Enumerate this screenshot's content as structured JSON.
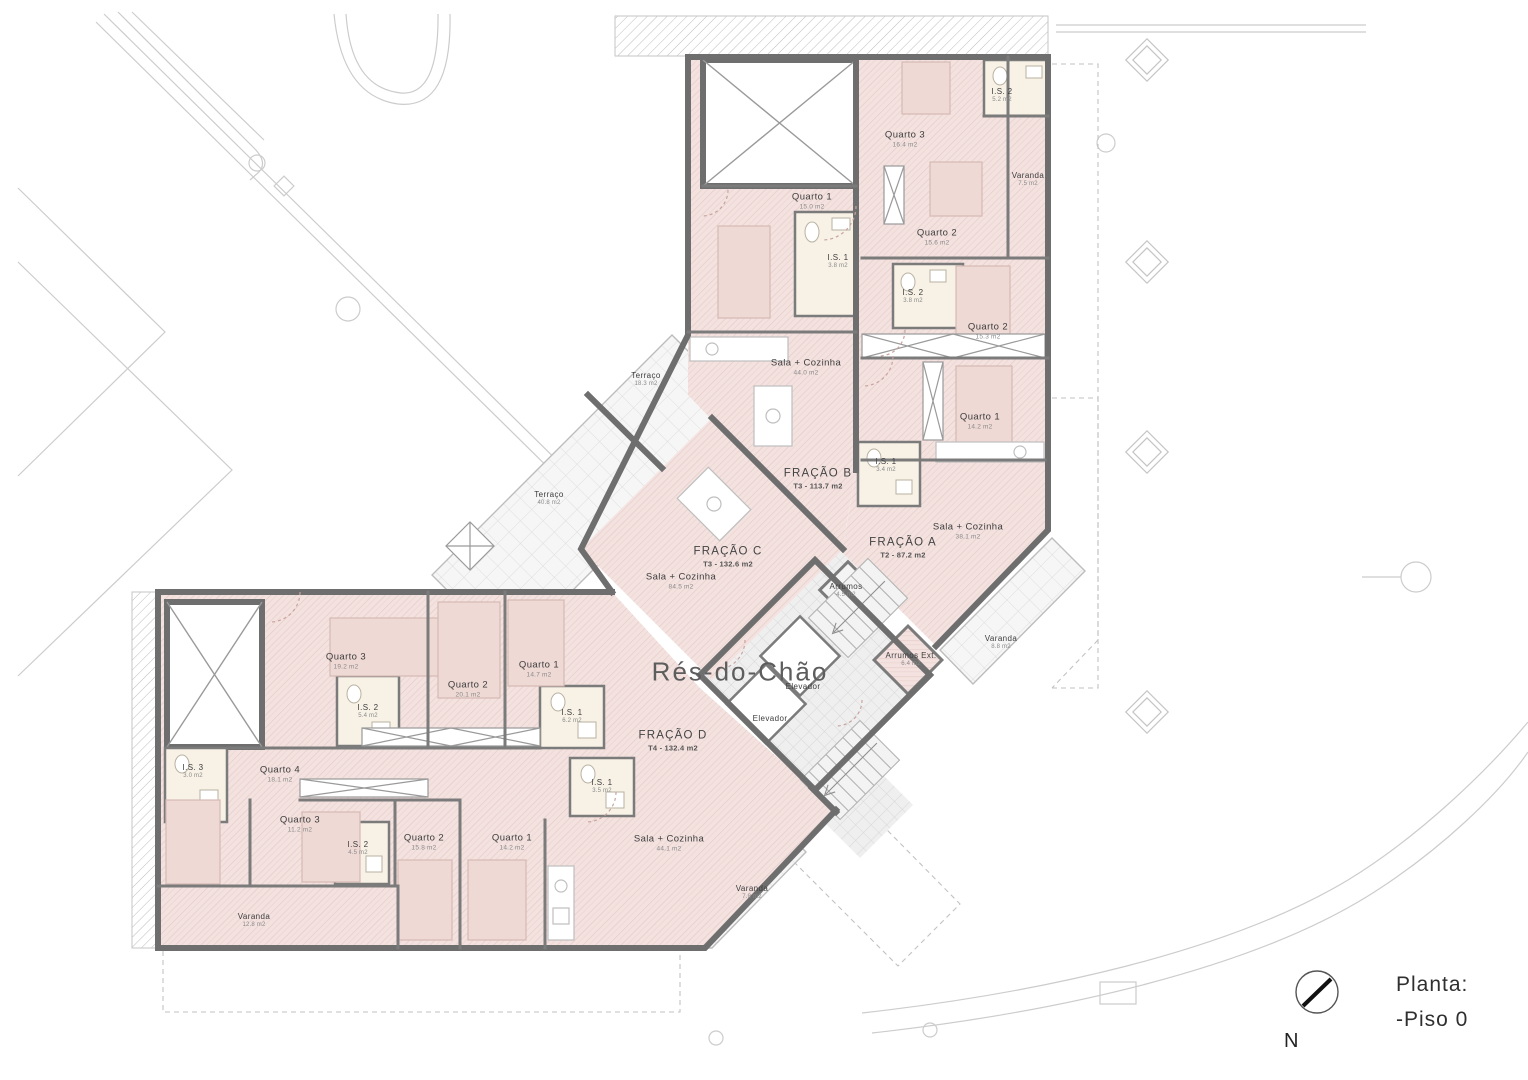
{
  "plan": {
    "floor_name": "Rés-do-Chão"
  },
  "title_block": {
    "label": "Planta:",
    "floor": "-Piso 0"
  },
  "compass": {
    "north": "N"
  },
  "palette": {
    "apartment_fill": "#f3e2df",
    "apartment_hatch": "#e4cac6",
    "terrace_fill": "#f6f6f6",
    "terrace_line": "#dddddd",
    "wall": "#6e6e6e",
    "bathroom_fill": "#f7f1e6",
    "site_line": "#cccccc",
    "text": "#3d3d3d"
  },
  "fractions_summary": [
    {
      "name": "FRAÇÃO A",
      "type_area": "T2 - 87.2 m2"
    },
    {
      "name": "FRAÇÃO B",
      "type_area": "T3 - 113.7 m2"
    },
    {
      "name": "FRAÇÃO C",
      "type_area": "T3 - 132.6 m2"
    },
    {
      "name": "FRAÇÃO D",
      "type_area": "T4 - 132.4 m2"
    }
  ],
  "rooms": [
    {
      "name": "Quarto 3",
      "area": "16.4 m2",
      "x": 905,
      "y": 140
    },
    {
      "name": "I.S. 2",
      "area": "5.2 m2",
      "x": 1002,
      "y": 96,
      "kind": "small"
    },
    {
      "name": "Varanda",
      "area": "7.5 m2",
      "x": 1028,
      "y": 180,
      "kind": "small"
    },
    {
      "name": "Quarto 2",
      "area": "15.6 m2",
      "x": 937,
      "y": 238
    },
    {
      "name": "Quarto 1",
      "area": "15.0 m2",
      "x": 812,
      "y": 202
    },
    {
      "name": "I.S. 1",
      "area": "3.8 m2",
      "x": 838,
      "y": 262,
      "kind": "small"
    },
    {
      "name": "Sala + Cozinha",
      "area": "44.0 m2",
      "x": 806,
      "y": 368
    },
    {
      "name": "I.S. 2",
      "area": "3.8 m2",
      "x": 913,
      "y": 297,
      "kind": "small"
    },
    {
      "name": "Quarto 2",
      "area": "15.3 m2",
      "x": 988,
      "y": 332
    },
    {
      "name": "Quarto 1",
      "area": "14.2 m2",
      "x": 980,
      "y": 422
    },
    {
      "name": "I.S. 1",
      "area": "3.4 m2",
      "x": 886,
      "y": 466,
      "kind": "small"
    },
    {
      "name": "Sala + Cozinha",
      "area": "38.1 m2",
      "x": 968,
      "y": 532
    },
    {
      "name": "FRAÇÃO A",
      "area": "T2 - 87.2 m2",
      "x": 903,
      "y": 548,
      "kind": "fraction"
    },
    {
      "name": "FRAÇÃO B",
      "area": "T3 - 113.7 m2",
      "x": 818,
      "y": 479,
      "kind": "fraction"
    },
    {
      "name": "Terraço",
      "area": "18.3 m2",
      "x": 646,
      "y": 380,
      "kind": "small"
    },
    {
      "name": "Terraço",
      "area": "40.8 m2",
      "x": 549,
      "y": 499,
      "kind": "small"
    },
    {
      "name": "FRAÇÃO C",
      "area": "T3 - 132.6 m2",
      "x": 728,
      "y": 557,
      "kind": "fraction"
    },
    {
      "name": "Sala + Cozinha",
      "area": "84.5 m2",
      "x": 681,
      "y": 582
    },
    {
      "name": "Elevador",
      "area": "",
      "x": 803,
      "y": 687,
      "kind": "small"
    },
    {
      "name": "Elevador",
      "area": "",
      "x": 770,
      "y": 719,
      "kind": "small"
    },
    {
      "name": "Arrumos",
      "area": "4.5 m2",
      "x": 846,
      "y": 591,
      "kind": "small"
    },
    {
      "name": "Arrumos Ext.",
      "area": "6.4 m2",
      "x": 911,
      "y": 660,
      "kind": "small"
    },
    {
      "name": "Varanda",
      "area": "8.8 m2",
      "x": 1001,
      "y": 643,
      "kind": "small"
    },
    {
      "name": "Quarto 3",
      "area": "19.2 m2",
      "x": 346,
      "y": 662
    },
    {
      "name": "I.S. 2",
      "area": "5.4 m2",
      "x": 368,
      "y": 712,
      "kind": "small"
    },
    {
      "name": "Quarto 2",
      "area": "20.1 m2",
      "x": 468,
      "y": 690
    },
    {
      "name": "Quarto 1",
      "area": "14.7 m2",
      "x": 539,
      "y": 670
    },
    {
      "name": "I.S. 1",
      "area": "6.2 m2",
      "x": 572,
      "y": 717,
      "kind": "small"
    },
    {
      "name": "FRAÇÃO D",
      "area": "T4 - 132.4 m2",
      "x": 673,
      "y": 741,
      "kind": "fraction"
    },
    {
      "name": "I.S. 1",
      "area": "3.5 m2",
      "x": 602,
      "y": 787,
      "kind": "small"
    },
    {
      "name": "I.S. 3",
      "area": "3.0 m2",
      "x": 193,
      "y": 772,
      "kind": "small"
    },
    {
      "name": "Quarto 4",
      "area": "18.1 m2",
      "x": 280,
      "y": 775
    },
    {
      "name": "Quarto 3",
      "area": "11.2 m2",
      "x": 300,
      "y": 825
    },
    {
      "name": "I.S. 2",
      "area": "4.5 m2",
      "x": 358,
      "y": 849,
      "kind": "small"
    },
    {
      "name": "Quarto 2",
      "area": "15.8 m2",
      "x": 424,
      "y": 843
    },
    {
      "name": "Quarto 1",
      "area": "14.2 m2",
      "x": 512,
      "y": 843
    },
    {
      "name": "Sala + Cozinha",
      "area": "44.1 m2",
      "x": 669,
      "y": 844
    },
    {
      "name": "Varanda",
      "area": "7.8 m2",
      "x": 752,
      "y": 893,
      "kind": "small"
    },
    {
      "name": "Varanda",
      "area": "12.8 m2",
      "x": 254,
      "y": 921,
      "kind": "small"
    }
  ]
}
